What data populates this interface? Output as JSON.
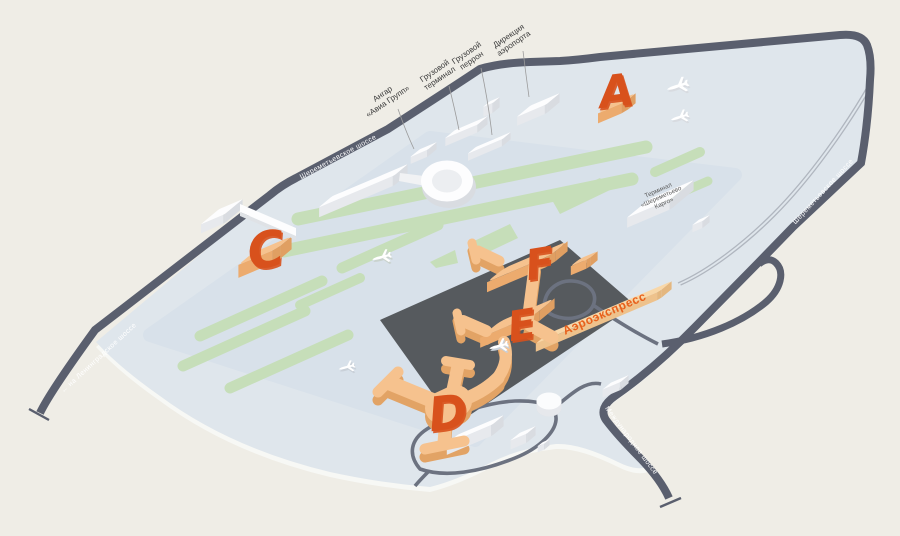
{
  "map": {
    "terminal_letters": {
      "a": "A",
      "c": "C",
      "d": "D",
      "e": "E",
      "f": "F"
    },
    "aeroexpress": {
      "label": "Аэроэкспресс"
    },
    "cargo_terminal_building": {
      "line1": "Терминал",
      "line2": "«Шереметьево",
      "line3": "Карго»"
    },
    "callouts": [
      {
        "id": "hangar",
        "line1": "Ангар",
        "line2": "«Авиа Групп»"
      },
      {
        "id": "cargo-terminal",
        "line1": "Грузовой",
        "line2": "терминал"
      },
      {
        "id": "cargo-apron",
        "line1": "Грузовой",
        "line2": "перрон"
      },
      {
        "id": "airport-directorate",
        "line1": "Дирекция",
        "line2": "аэропорта"
      }
    ],
    "road_labels": {
      "top": "Шереметьевское шоссе",
      "right": "Шереметьевское шоссе",
      "left": "← на Ленинградское шоссе",
      "bottom": "Международное шоссе"
    },
    "colors": {
      "background": "#efede6",
      "grounds": "#dfe6ec",
      "airfield": "#d8e1ea",
      "greenery": "#c6deb9",
      "road": "#5a5f6e",
      "terminal_fill": "#f6c28e",
      "terminal_letter": "#d8511c",
      "aeroexpress_text": "#e8611c",
      "building_white": "#ffffff"
    }
  }
}
